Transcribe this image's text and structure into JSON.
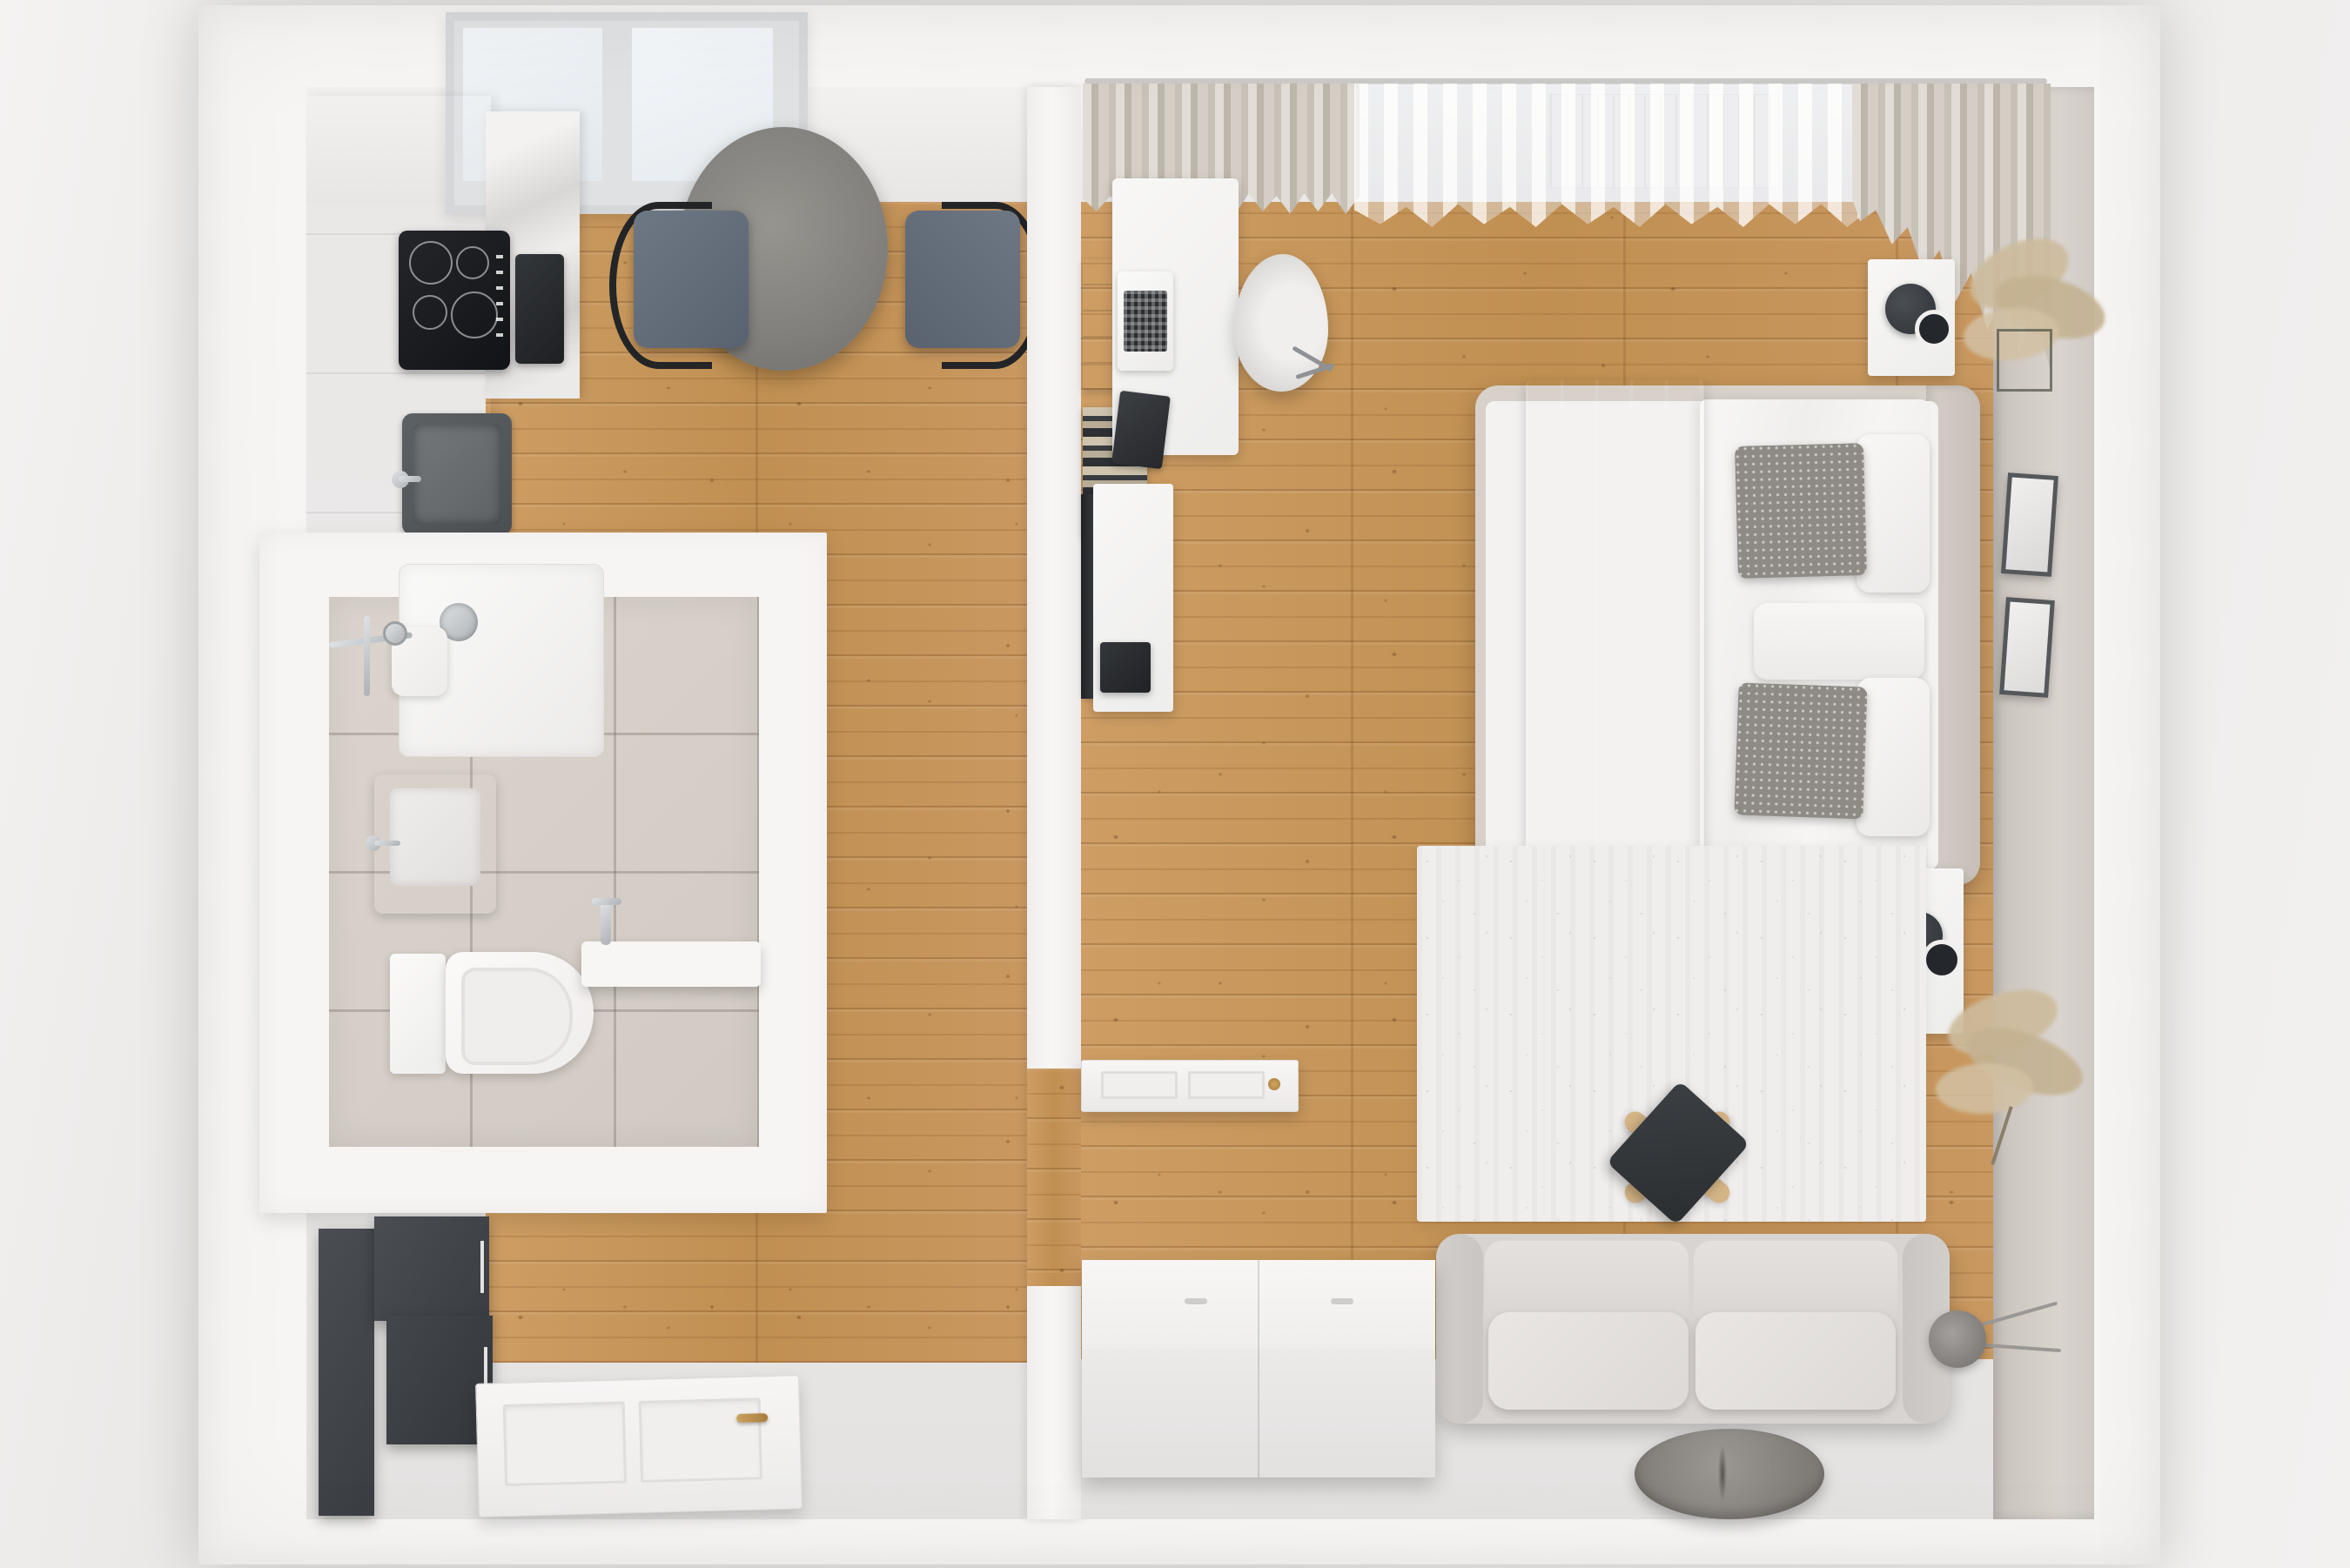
{
  "meta": {
    "title": "Top-view 3D render of a one-bedroom apartment floor plan",
    "view": "top-down 3D architectural visualization"
  },
  "palette": {
    "wood_floor": "#c8975c",
    "gray_floor": "#e9e7e6",
    "wall_white": "#f6f5f4",
    "wall_beige": "#d2ccc6",
    "bathroom_tile": "#d8d1ca",
    "charcoal_furniture": "#3f4348",
    "chrome": "#c3c6c9",
    "brass_handle": "#b98e4a",
    "textile_gray": "#8e8b85"
  },
  "labels": {
    "page": "Apartment 3D floor plan render",
    "apartment": "Apartment outer walls",
    "kitchen": "Kitchen",
    "bathroom": "Bathroom",
    "hallway": "Hallway / entry",
    "living_room": "Living room and bedroom",
    "ceiling_band": "Kitchen top wall",
    "window": "Kitchen window",
    "cabinets": "Kitchen cabinet run with countertop",
    "marble": "Marble backsplash panel",
    "cooktop": "Induction cooktop",
    "oven": "Built-in oven",
    "sink_kitchen": "Kitchen sink with faucet",
    "table": "Round dining table",
    "chair_left": "Dining chair (left)",
    "chair_right": "Dining chair (right)",
    "tiles": "Bathroom tile floor",
    "shower": "Shower tray",
    "shower_drain": "Shower drain",
    "shower_set": "Chrome shower fixture",
    "shower_shelf": "Shower shelf",
    "basin": "Wall-hung washbasin",
    "toilet": "Wall-hung toilet",
    "vanity": "Floating vanity shelf with faucet",
    "wardrobe": "Hallway wardrobe (charcoal)",
    "entrance_door": "Entrance door (open, top view)",
    "door_handle": "Brass door handle",
    "partition": "Partition wall",
    "door_living": "Living room door (open, top view)",
    "curtain_rod": "Curtain rod",
    "curtain_left": "Pleated curtain (left)",
    "curtain_sheer": "Sheer curtain",
    "curtain_right": "Pleated curtain (right corner)",
    "radiator": "Radiator under window",
    "desk": "White desk",
    "laptop": "Open laptop",
    "notebook": "Dark notebook",
    "books": "Books and storage boxes",
    "office_chair": "Office chair",
    "tv": "Wall-mounted TV (edge view)",
    "console": "TV console sideboard",
    "tv_box": "Black media box",
    "bed": "Double bed",
    "headboard": "Upholstered headboard",
    "throw": "Gray bedspread throw",
    "duvet": "White duvet",
    "pillow_gray_1": "Textured gray cushion (top)",
    "pillow_gray_2": "Textured gray cushion (bottom)",
    "pillow_white_1": "White pillow (top)",
    "pillow_white_2": "White pillow (bottom)",
    "pillow_roll": "White cushion between pillows",
    "nightstand_top": "Nightstand (window side)",
    "lamp_top": "Table lamp (dark, top view)",
    "nightstand_bottom": "Nightstand (rug side)",
    "lamp_bottom": "Table lamp (dark, top view)",
    "frame_1": "Picture frame (upper)",
    "frame_2": "Picture frame (lower)",
    "plant_top": "Dried pampas grass (corner)",
    "plant_bottom": "Dried pampas grass (by nightstand)",
    "rug": "Mottled area rug",
    "stool": "X-leg coffee stool",
    "tray": "Dark serving tray",
    "sofa": "Two-seat sofa",
    "sofa_back_1": "Backrest cushion (left)",
    "sofa_back_2": "Backrest cushion (right)",
    "sofa_seat_1": "Seat cushion (left)",
    "sofa_seat_2": "Seat cushion (right)",
    "armrest_left": "Sofa armrest (left)",
    "armrest_right": "Sofa armrest (right)",
    "chest": "White storage chest",
    "pouf": "Round gray pouf",
    "arc_lamp": "Arc floor lamp",
    "right_wall": "Bedroom wall (beige) with frames",
    "gray_floor": "Light gray floor zone",
    "wood_floor": "Pine plank flooring"
  }
}
